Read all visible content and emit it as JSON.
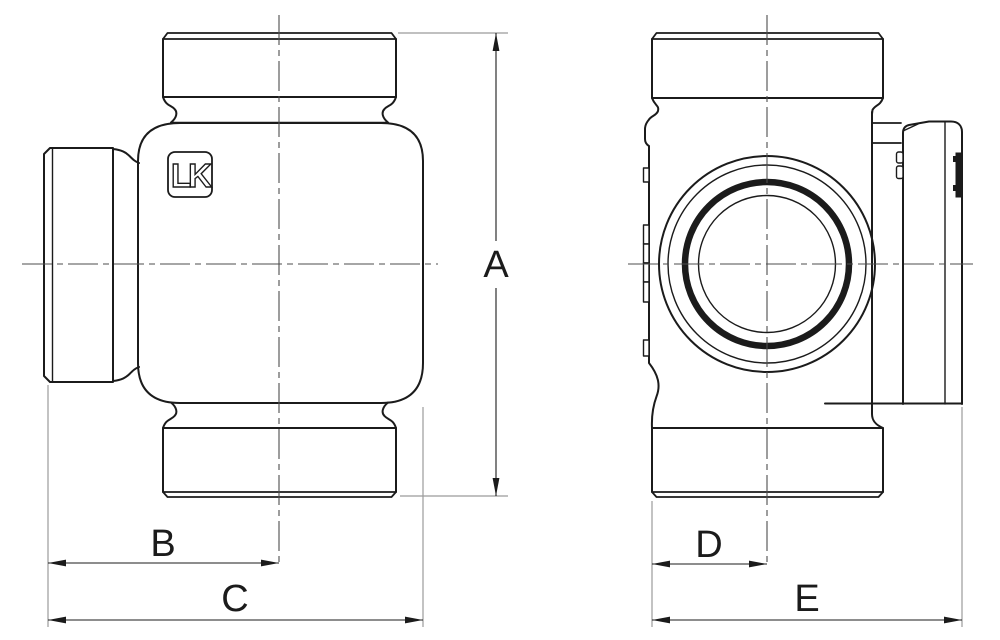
{
  "style": {
    "outline_color": "#1b1b1b",
    "centerline_color": "#4d4d4d",
    "extension_line_color": "#9b9b9b",
    "dimension_color": "#1b1b1b",
    "background": "#ffffff"
  },
  "logo": {
    "text": "LK"
  },
  "dimensions": {
    "a": {
      "label": "A"
    },
    "b": {
      "label": "B"
    },
    "c": {
      "label": "C"
    },
    "d": {
      "label": "D"
    },
    "e": {
      "label": "E"
    }
  }
}
